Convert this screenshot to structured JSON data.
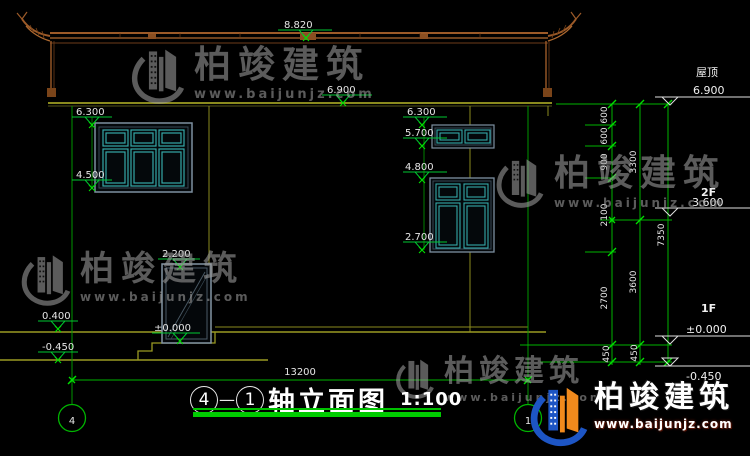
{
  "watermark": {
    "brand": "柏竣建筑",
    "url": "www.baijunjz.com"
  },
  "brand_logo": {
    "name": "柏竣建筑",
    "url": "www.baijunjz.com"
  },
  "title_block": {
    "axis_from": "4",
    "joiner": "—",
    "axis_to": "1",
    "name": "轴立面图",
    "scale": "1:100"
  },
  "axes": {
    "left": "4",
    "right": "1"
  },
  "floor_labels": {
    "roof": "屋顶",
    "roof_level": "6.900",
    "f2": "2F",
    "f2_level": "3.600",
    "f1": "1F",
    "f1_level": "±0.000",
    "ground_level": "-0.450"
  },
  "elevation_markers": {
    "ridge": "8.820",
    "eave": "6.900",
    "win_left_top": "6.300",
    "win_left_bottom": "4.500",
    "win_mid_upper_top": "6.300",
    "win_mid_upper_bottom": "5.700",
    "win_mid_lower_top": "4.800",
    "win_mid_lower_bottom": "2.700",
    "door_top": "2.200",
    "door_floor": "±0.000",
    "plinth": "0.400",
    "ground": "-0.450"
  },
  "dimensions": {
    "overall_width": "13200",
    "right_inner": [
      "600",
      "600",
      "900",
      "2100",
      "2700",
      "450"
    ],
    "right_middle": [
      "3300",
      "3600",
      "450"
    ],
    "right_overall": "7350"
  }
}
